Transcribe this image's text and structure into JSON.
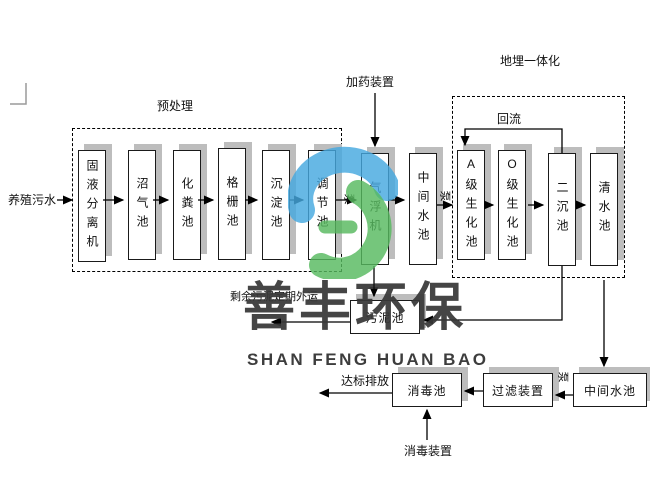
{
  "labels": {
    "influent": "养殖污水",
    "pretreatment": "预处理",
    "dosing_device": "加药装置",
    "buried_integration": "地埋一体化",
    "reflux": "回流",
    "sludge_out": "剩余污泥定期外运",
    "discharge": "达标排放",
    "disinfect_device": "消毒装置",
    "pump": "泵"
  },
  "nodes": {
    "solid_liquid_separator": "固液分离机",
    "biogas_tank": "沼气池",
    "septic_tank": "化粪池",
    "grille_tank": "格栅池",
    "sedimentation_tank": "沉淀池",
    "regulating_tank": "调节池",
    "air_flotation": "气浮机",
    "intermediate_pool_1": "中间水池",
    "a_bio_tank": "A级生化池",
    "o_bio_tank": "O级生化池",
    "secondary_sed_tank": "二沉池",
    "clear_water_tank": "清水池",
    "sludge_tank": "污泥池",
    "disinfection_tank": "消毒池",
    "filter_device": "过滤装置",
    "intermediate_pool_2": "中间水池"
  },
  "watermark": {
    "cn": "善丰环保",
    "en": "SHAN FENG HUAN BAO"
  },
  "colors": {
    "box_shadow": "#bdbdbd",
    "box_border": "#1a1a1a",
    "logo_blue": "#45a8df",
    "logo_green": "#57b95f",
    "watermark_text": "#383838"
  }
}
